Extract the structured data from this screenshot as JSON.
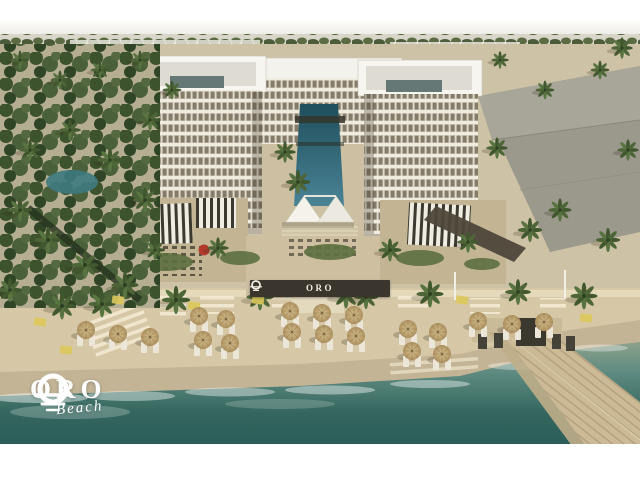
{
  "meta": {
    "title": "ORO Beach — beachfront resort aerial rendering",
    "type": "architectural-rendering"
  },
  "branding": {
    "logo_text": "ORO",
    "logo_subtext": "Beach",
    "logo_icon": "sun-over-waves-icon"
  },
  "sign": {
    "text": "ORO",
    "icon": "sun-over-waves-icon"
  },
  "scene": {
    "description": "Aerial rendering of a white U-shaped beachfront hotel with a long central courtyard pool, striped pergola terraces, an event canopy, a palm-lined sandy beach with straw umbrellas and loungers, and a wooden pier extending into turquoise sea.",
    "colors": {
      "frame": "#ffffff",
      "sky_haze": "#f2f0ea",
      "distant_band": "#d9d5c8",
      "facade": "#ded8c9",
      "facade_slab": "#f0ebdf",
      "window": "#847b69",
      "roof": "#f6f5f0",
      "gray_building": "#9b998c",
      "pool_dark": "#1f4e5c",
      "pool_light": "#4a8496",
      "terrace_sand": "#c3b593",
      "canopy_dark": "#3c3a30",
      "canopy_light": "#efece2",
      "beach_sand": "#d6c8a7",
      "wet_sand": "#c4b496",
      "sea_shallow": "#97a68e",
      "sea_deep": "#27514f",
      "umbrella": "#c8ab77",
      "pier_wood": "#ccb995",
      "palm_green": "#41582f",
      "sign_wall": "#3a362d",
      "mat": "#ddc85a",
      "accent_red_umbrella": "#b33a2c",
      "logo_white": "#ffffff"
    },
    "umbrellas": [
      [
        86,
        330
      ],
      [
        118,
        334
      ],
      [
        150,
        337
      ],
      [
        199,
        316
      ],
      [
        226,
        319
      ],
      [
        203,
        340
      ],
      [
        230,
        343
      ],
      [
        290,
        311
      ],
      [
        292,
        332
      ],
      [
        322,
        313
      ],
      [
        324,
        334
      ],
      [
        354,
        315
      ],
      [
        356,
        336
      ],
      [
        408,
        329
      ],
      [
        438,
        332
      ],
      [
        412,
        351
      ],
      [
        442,
        354
      ],
      [
        478,
        321
      ],
      [
        512,
        324
      ],
      [
        544,
        322
      ]
    ],
    "palms": [
      [
        62,
        306,
        1
      ],
      [
        102,
        304,
        1
      ],
      [
        176,
        300,
        1.05
      ],
      [
        260,
        297,
        1
      ],
      [
        346,
        295,
        1
      ],
      [
        366,
        297,
        0.9
      ],
      [
        430,
        294,
        1
      ],
      [
        518,
        292,
        0.95
      ],
      [
        584,
        296,
        1
      ],
      [
        285,
        152,
        0.8
      ],
      [
        298,
        182,
        0.9
      ],
      [
        218,
        248,
        0.8
      ],
      [
        390,
        250,
        0.85
      ],
      [
        468,
        242,
        0.8
      ],
      [
        155,
        250,
        0.75
      ],
      [
        497,
        148,
        0.8
      ],
      [
        530,
        230,
        0.9
      ],
      [
        560,
        210,
        0.85
      ],
      [
        608,
        240,
        0.9
      ],
      [
        628,
        150,
        0.8
      ],
      [
        545,
        90,
        0.7
      ],
      [
        600,
        70,
        0.7
      ],
      [
        500,
        60,
        0.65
      ],
      [
        622,
        48,
        0.8
      ],
      [
        20,
        210,
        0.9
      ],
      [
        48,
        240,
        1
      ],
      [
        85,
        265,
        1
      ],
      [
        125,
        285,
        1
      ],
      [
        30,
        150,
        0.8
      ],
      [
        70,
        130,
        0.8
      ],
      [
        110,
        160,
        0.9
      ],
      [
        145,
        200,
        0.9
      ],
      [
        10,
        290,
        0.9
      ],
      [
        150,
        120,
        0.8
      ],
      [
        60,
        80,
        0.7
      ],
      [
        100,
        70,
        0.7
      ],
      [
        20,
        60,
        0.7
      ],
      [
        140,
        60,
        0.7
      ],
      [
        172,
        90,
        0.7
      ]
    ],
    "mats": [
      [
        40,
        322
      ],
      [
        66,
        350
      ],
      [
        118,
        300
      ],
      [
        194,
        306
      ],
      [
        258,
        300
      ],
      [
        462,
        300
      ],
      [
        586,
        318
      ]
    ]
  }
}
